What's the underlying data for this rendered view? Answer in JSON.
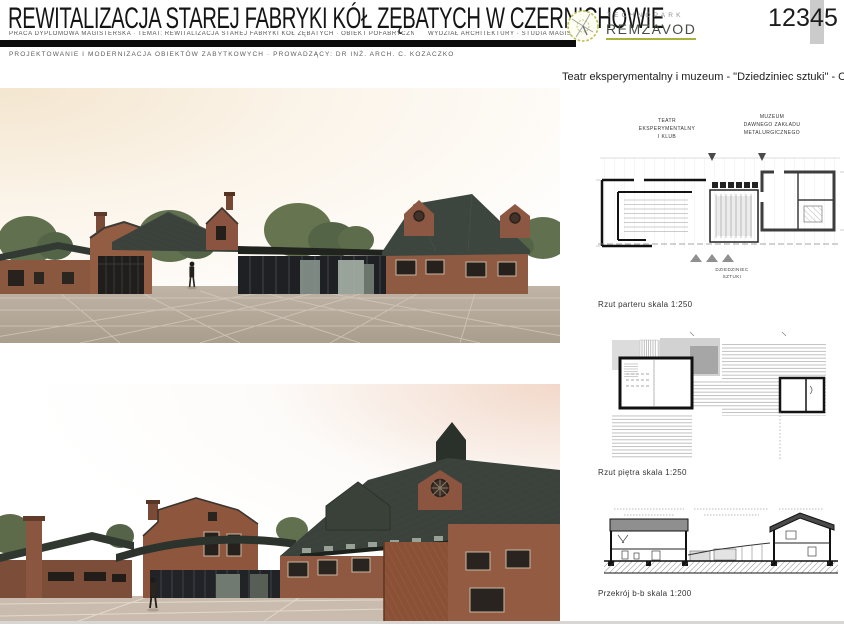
{
  "header": {
    "title": "REWITALIZACJA STAREJ FABRYKI KÓŁ ZĘBATYCH W CZERNICHOWIE",
    "meta_left": "PRACA DYPLOMOWA MAGISTERSKA  ·  TEMAT: REWITALIZACJA STAREJ FABRYKI KÓŁ ZĘBATYCH  ·  OBIEKT POFABRYCZNY",
    "meta_right": "WYDZIAŁ ARCHITEKTURY · STUDIA MAGISTERSKIE · RYS. 4",
    "course_line": "PROJEKTOWANIE I MODERNIZACJA OBIEKTÓW ZABYTKOWYCH  ·  PROWADZĄCY:  DR INŻ. ARCH. C. KOZACZKO"
  },
  "logo": {
    "line1": "TECHNOPARK",
    "line2": "REMZAVOD"
  },
  "pager": {
    "digits": [
      "1",
      "2",
      "3",
      "4",
      "5"
    ],
    "active_index": 3
  },
  "panel": {
    "heading": "Teatr eksperymentalny i muzeum - \"Dziedziniec sztuki\" - Obiekt",
    "plan_ground": {
      "theatre_label_1": "TEATR",
      "theatre_label_2": "EKSPERYMENTALNY",
      "theatre_label_3": "I KLUB",
      "museum_label_1": "MUZEUM",
      "museum_label_2": "DAWNEGO ZAKŁADU",
      "museum_label_3": "METALURGICZNEGO",
      "courtyard_label_1": "DZIEDZINIEC",
      "courtyard_label_2": "SZTUKI",
      "caption": "Rzut parteru skala 1:250"
    },
    "plan_upper": {
      "caption": "Rzut piętra skala 1:250"
    },
    "section": {
      "caption": "Przekrój b-b skala 1:200"
    }
  },
  "colors": {
    "brick": "#8f5841",
    "roof": "#3a423b",
    "glass": "#212327",
    "plaza": "#b7ab9d",
    "logo_olive": "#aab03c",
    "pager_highlight": "#cbcbcb"
  }
}
